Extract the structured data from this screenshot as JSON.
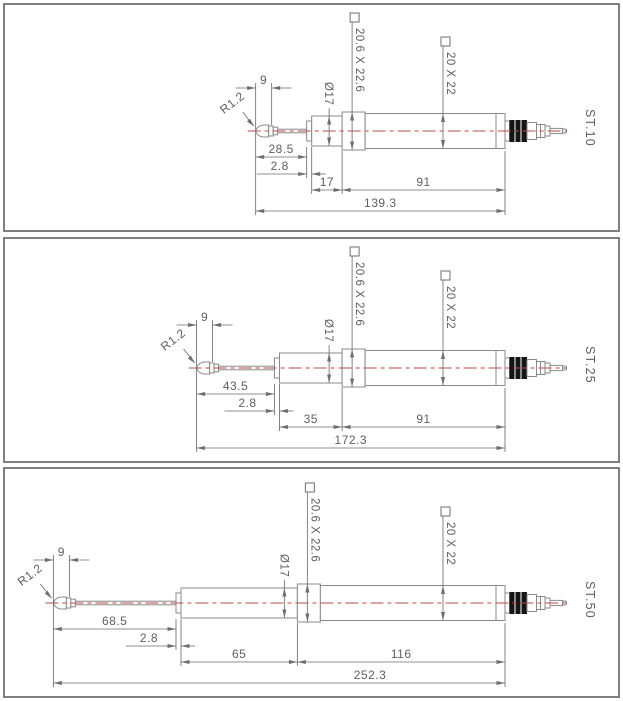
{
  "style": {
    "background": "#ffffff",
    "panel_border_color": "#7f7f7f",
    "line_color": "#8a8a8a",
    "dim_color": "#6e6e6e",
    "text_color": "#5f5f5f",
    "centerline_color": "#bb4a4a",
    "connector_band_color": "#151515"
  },
  "drawing": {
    "units": "mm",
    "scale_px_per_mm": 1.79,
    "panels": [
      {
        "id": "st10",
        "model_label": "ST.10",
        "tip_width_label": "9",
        "tip_radius_label": "R1.2",
        "collar_dia_label": "Ø17",
        "flange_section_label": "20.6 X 22.6",
        "body_section_label": "20 X 22",
        "spindle_label": "28.5",
        "spindle_mm": 28.5,
        "neck_label": "2.8",
        "neck_mm": 2.8,
        "collar_label": "17",
        "collar_mm": 17,
        "body_label": "91",
        "body_mm": 91,
        "total_label": "139.3",
        "total_mm": 139.3
      },
      {
        "id": "st25",
        "model_label": "ST.25",
        "tip_width_label": "9",
        "tip_radius_label": "R1.2",
        "collar_dia_label": "Ø17",
        "flange_section_label": "20.6 X 22.6",
        "body_section_label": "20 X 22",
        "spindle_label": "43.5",
        "spindle_mm": 43.5,
        "neck_label": "2.8",
        "neck_mm": 2.8,
        "collar_label": "35",
        "collar_mm": 35,
        "body_label": "91",
        "body_mm": 91,
        "total_label": "172.3",
        "total_mm": 172.3
      },
      {
        "id": "st50",
        "model_label": "ST.50",
        "tip_width_label": "9",
        "tip_radius_label": "R1.2",
        "collar_dia_label": "Ø17",
        "flange_section_label": "20.6 X 22.6",
        "body_section_label": "20 X 22",
        "spindle_label": "68.5",
        "spindle_mm": 68.5,
        "neck_label": "2.8",
        "neck_mm": 2.8,
        "collar_label": "65",
        "collar_mm": 65,
        "body_label": "116",
        "body_mm": 116,
        "total_label": "252.3",
        "total_mm": 252.3
      }
    ]
  }
}
